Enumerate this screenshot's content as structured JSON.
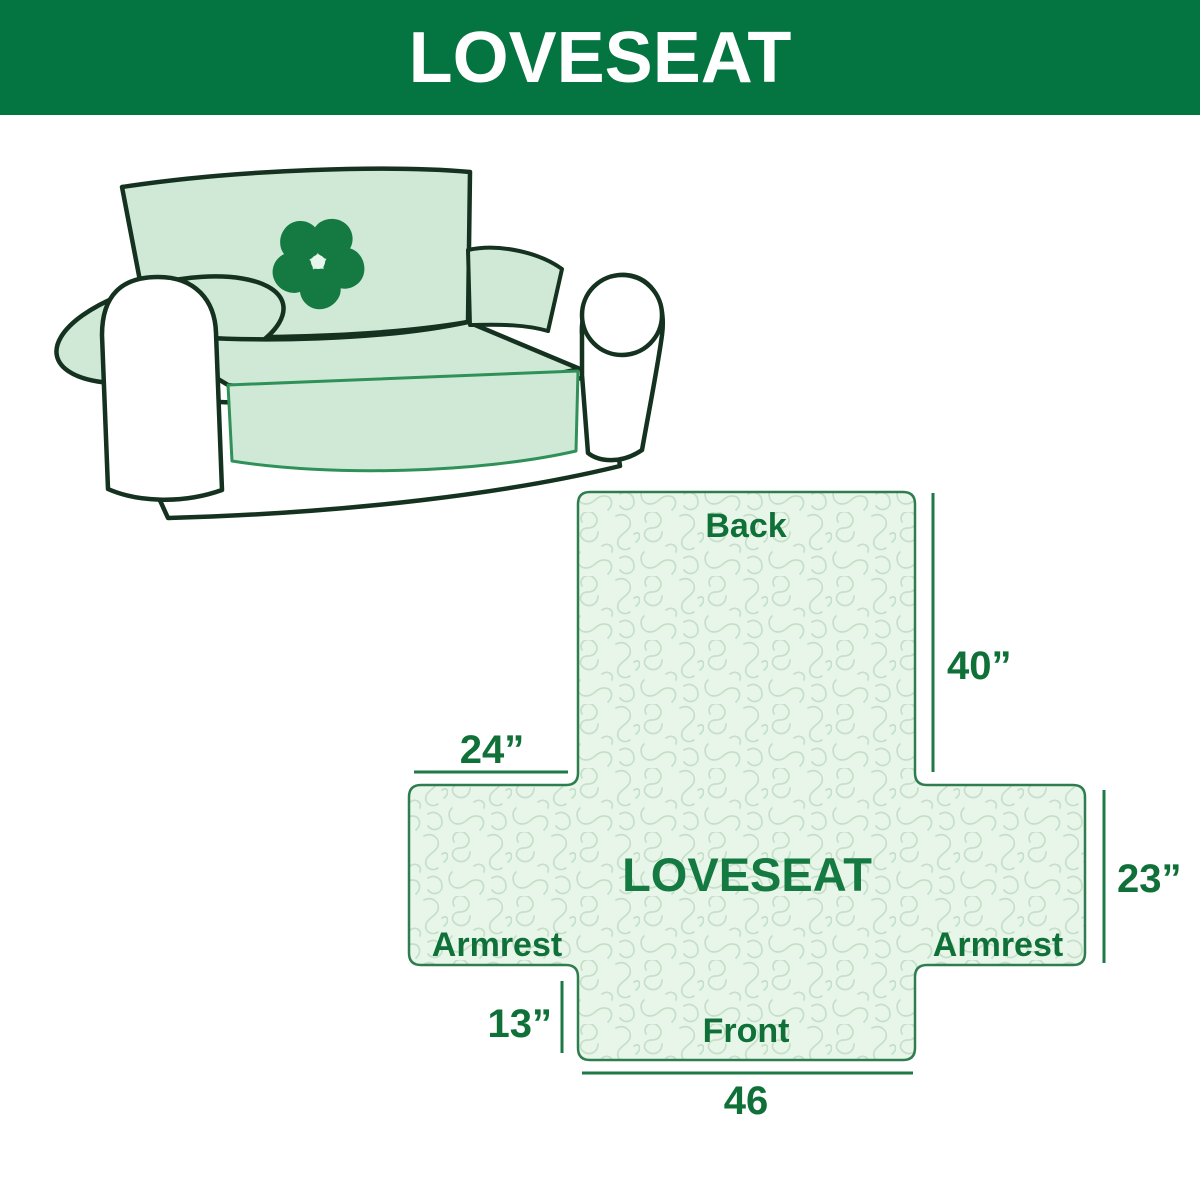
{
  "header": {
    "title": "LOVESEAT"
  },
  "palette": {
    "banner_green": "#047540",
    "cover_mint": "#cfe9d6",
    "sofa_outline_dark": "#14321f",
    "diagram_fill": "#e8f6ea",
    "diagram_pattern_line": "#c5dfc8",
    "diagram_outline": "#2e7d4f",
    "diagram_text_green": "#0f7038",
    "dimension_line_green": "#1e7a44",
    "logo_green": "#157a42"
  },
  "sofa": {
    "logo": "pinwheel-icon"
  },
  "diagram": {
    "center_label": "LOVESEAT",
    "back_label": "Back",
    "front_label": "Front",
    "armrest_left_label": "Armrest",
    "armrest_right_label": "Armrest",
    "dim_back_height": "40”",
    "dim_armrest_width": "24”",
    "dim_armrest_height": "23”",
    "dim_front_height": "13”",
    "dim_front_width": "46"
  }
}
